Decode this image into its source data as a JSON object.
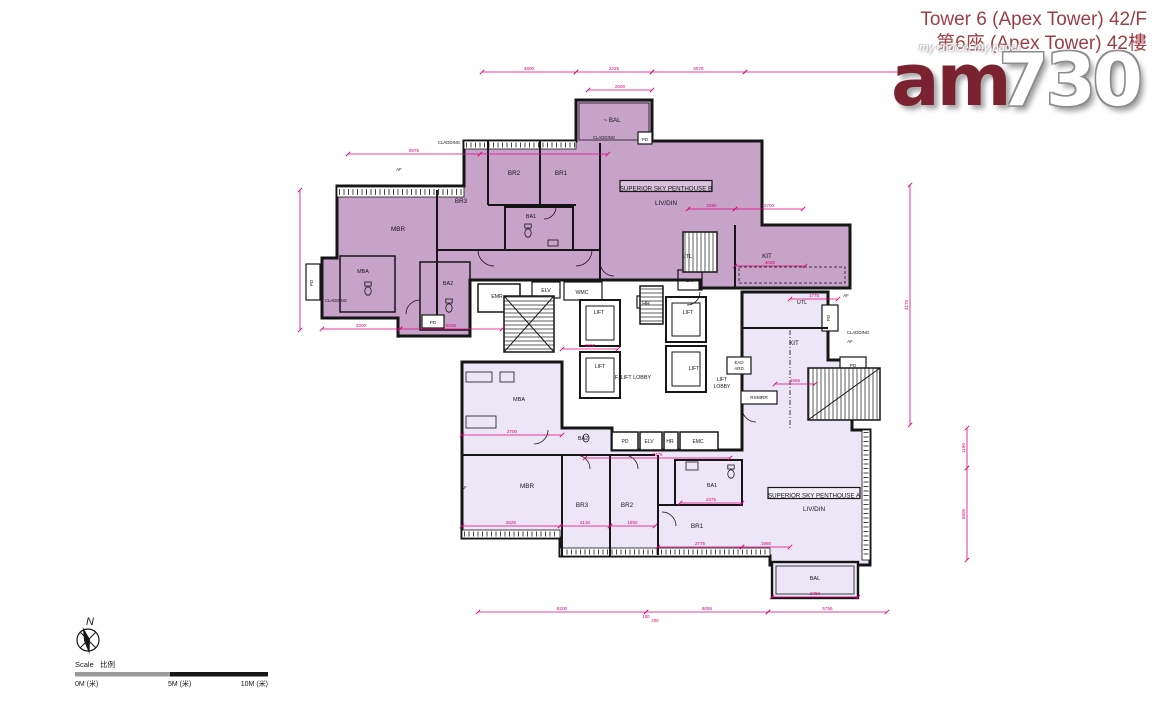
{
  "header": {
    "title_line1": "Tower 6 (Apex Tower) 42/F",
    "title_line2": "第6座 (Apex Tower) 42樓"
  },
  "watermark": {
    "brand_am": "am",
    "brand_730": "730",
    "tagline": "my choice, my paper"
  },
  "colors": {
    "penthouse_b_fill": "#c7a2c9",
    "penthouse_a_fill": "#ece6f6",
    "dimension_pink": "#e0007a",
    "wall_black": "#161616",
    "title_red": "#9c3f45",
    "logo_maroon": "#7a2230",
    "scale_gray": "#9a9a9a"
  },
  "plan": {
    "unit_labels": [
      {
        "text": "SUPERIOR SKY PENTHOUSE B",
        "cx": 666,
        "cy": 189,
        "w": 92,
        "h": 11
      },
      {
        "text": "SUPERIOR SKY PENTHOUSE A",
        "cx": 814,
        "cy": 496,
        "w": 92,
        "h": 11
      }
    ],
    "room_labels": [
      {
        "text": "MBR",
        "x": 398,
        "y": 231
      },
      {
        "text": "BR3",
        "x": 461,
        "y": 203
      },
      {
        "text": "BR2",
        "x": 514,
        "y": 175
      },
      {
        "text": "BR1",
        "x": 561,
        "y": 175
      },
      {
        "text": "BA1",
        "x": 531,
        "y": 218,
        "s": 5.4
      },
      {
        "text": "MBA",
        "x": 363,
        "y": 273,
        "s": 5.4
      },
      {
        "text": "BA2",
        "x": 448,
        "y": 285,
        "s": 5.4
      },
      {
        "text": "LIV/DIN",
        "x": 666,
        "y": 205
      },
      {
        "text": "~ BAL",
        "x": 612,
        "y": 122
      },
      {
        "text": "UTL",
        "x": 687,
        "y": 258,
        "s": 5.4
      },
      {
        "text": "KIT",
        "x": 767,
        "y": 258
      },
      {
        "text": "LAV",
        "x": 690,
        "y": 282,
        "s": 4.6
      },
      {
        "text": "EMR",
        "x": 497,
        "y": 298,
        "s": 5.2
      },
      {
        "text": "ELV",
        "x": 546,
        "y": 292,
        "s": 5.2
      },
      {
        "text": "WMC",
        "x": 582,
        "y": 294,
        "s": 5.2
      },
      {
        "text": "HR",
        "x": 646,
        "y": 305,
        "s": 5.2
      },
      {
        "text": "LIFT",
        "x": 599,
        "y": 314,
        "s": 5.2
      },
      {
        "text": "LIFT",
        "x": 600,
        "y": 368,
        "s": 5.2
      },
      {
        "text": "LIFT",
        "x": 688,
        "y": 314,
        "s": 5.2
      },
      {
        "text": "LIFT",
        "x": 694,
        "y": 370,
        "s": 5.2
      },
      {
        "text": "F. LIFT LOBBY",
        "x": 633,
        "y": 379,
        "s": 5.4
      },
      {
        "text": "LIFT",
        "x": 722,
        "y": 381,
        "s": 5
      },
      {
        "text": "LOBBY",
        "x": 722,
        "y": 388,
        "s": 5
      },
      {
        "text": "EAD",
        "x": 739,
        "y": 364,
        "s": 4.4
      },
      {
        "text": "ARD",
        "x": 739,
        "y": 370,
        "s": 4.4
      },
      {
        "text": "RSMRR",
        "x": 759,
        "y": 399,
        "s": 4.8
      },
      {
        "text": "PD",
        "x": 625,
        "y": 443,
        "s": 5
      },
      {
        "text": "ELV",
        "x": 649,
        "y": 443,
        "s": 5
      },
      {
        "text": "HR",
        "x": 670,
        "y": 443,
        "s": 5
      },
      {
        "text": "EMC",
        "x": 698,
        "y": 443,
        "s": 5
      },
      {
        "text": "PD",
        "x": 433,
        "y": 324,
        "s": 4.6
      },
      {
        "text": "PD",
        "x": 313,
        "y": 283,
        "s": 4.6,
        "rot": -90
      },
      {
        "text": "PD",
        "x": 645,
        "y": 141,
        "s": 4.4
      },
      {
        "text": "MBA",
        "x": 519,
        "y": 401,
        "s": 5.6
      },
      {
        "text": "BA2",
        "x": 583,
        "y": 440,
        "s": 5.4
      },
      {
        "text": "MBR",
        "x": 527,
        "y": 488
      },
      {
        "text": "BR3",
        "x": 582,
        "y": 507
      },
      {
        "text": "BR2",
        "x": 627,
        "y": 507
      },
      {
        "text": "BR1",
        "x": 697,
        "y": 528
      },
      {
        "text": "BA1",
        "x": 712,
        "y": 487,
        "s": 5.4
      },
      {
        "text": "LIV/DIN",
        "x": 814,
        "y": 511
      },
      {
        "text": "BAL",
        "x": 815,
        "y": 580,
        "s": 5.6
      },
      {
        "text": "UTL",
        "x": 802,
        "y": 304,
        "s": 5.4
      },
      {
        "text": "KIT",
        "x": 794,
        "y": 345
      },
      {
        "text": "PD",
        "x": 830,
        "y": 318,
        "s": 4.6,
        "rot": -90
      },
      {
        "text": "PD",
        "x": 853,
        "y": 367,
        "s": 4.6
      }
    ],
    "annotations": [
      {
        "text": "CLADDING",
        "x": 449,
        "y": 144
      },
      {
        "text": "CLADDING",
        "x": 604,
        "y": 139
      },
      {
        "text": "CLADDING",
        "x": 336,
        "y": 302
      },
      {
        "text": "CLADDING",
        "x": 858,
        "y": 334
      },
      {
        "text": "AF",
        "x": 399,
        "y": 171
      },
      {
        "text": "AF",
        "x": 850,
        "y": 343
      },
      {
        "text": "AF",
        "x": 846,
        "y": 297
      },
      {
        "text": "AF",
        "x": 399,
        "y": 338
      },
      {
        "text": "AF",
        "x": 464,
        "y": 489
      }
    ],
    "dimensions": [
      {
        "o": "h",
        "x1": 482,
        "x2": 576,
        "y": 72,
        "label": "4800"
      },
      {
        "o": "h",
        "x1": 576,
        "x2": 652,
        "y": 72,
        "label": "2225"
      },
      {
        "o": "h",
        "x1": 652,
        "x2": 745,
        "y": 72,
        "label": "6075"
      },
      {
        "o": "h",
        "x1": 745,
        "x2": 905,
        "y": 72,
        "label": ""
      },
      {
        "o": "h",
        "x1": 588,
        "x2": 652,
        "y": 90,
        "label": "2600"
      },
      {
        "o": "h",
        "x1": 348,
        "x2": 480,
        "y": 154,
        "label": "8975"
      },
      {
        "o": "h",
        "x1": 480,
        "x2": 608,
        "y": 154,
        "label": ""
      },
      {
        "o": "h",
        "x1": 322,
        "x2": 400,
        "y": 329,
        "label": "3300"
      },
      {
        "o": "h",
        "x1": 400,
        "x2": 502,
        "y": 329,
        "label": "6035"
      },
      {
        "o": "h",
        "x1": 688,
        "x2": 735,
        "y": 209,
        "label": "2380"
      },
      {
        "o": "h",
        "x1": 735,
        "x2": 803,
        "y": 209,
        "label": "2700"
      },
      {
        "o": "h",
        "x1": 735,
        "x2": 805,
        "y": 266,
        "label": "4000"
      },
      {
        "o": "h",
        "x1": 790,
        "x2": 838,
        "y": 299,
        "label": "1775"
      },
      {
        "o": "h",
        "x1": 562,
        "x2": 618,
        "y": 349,
        "label": "2800"
      },
      {
        "o": "h",
        "x1": 462,
        "x2": 562,
        "y": 435,
        "label": "2700"
      },
      {
        "o": "h",
        "x1": 585,
        "x2": 730,
        "y": 458,
        "label": "7475"
      },
      {
        "o": "h",
        "x1": 680,
        "x2": 742,
        "y": 503,
        "label": "2375"
      },
      {
        "o": "h",
        "x1": 462,
        "x2": 560,
        "y": 526,
        "label": "2625"
      },
      {
        "o": "h",
        "x1": 560,
        "x2": 610,
        "y": 526,
        "label": "2130"
      },
      {
        "o": "h",
        "x1": 610,
        "x2": 655,
        "y": 526,
        "label": "1850"
      },
      {
        "o": "h",
        "x1": 658,
        "x2": 742,
        "y": 547,
        "label": "2775"
      },
      {
        "o": "h",
        "x1": 742,
        "x2": 790,
        "y": 547,
        "label": "1980"
      },
      {
        "o": "h",
        "x1": 775,
        "x2": 815,
        "y": 384,
        "label": "1965"
      },
      {
        "o": "h",
        "x1": 772,
        "x2": 858,
        "y": 597,
        "label": "2750"
      },
      {
        "o": "h",
        "x1": 478,
        "x2": 646,
        "y": 612,
        "label": "8200"
      },
      {
        "o": "h",
        "x1": 646,
        "x2": 768,
        "y": 612,
        "label": "6055"
      },
      {
        "o": "h",
        "x1": 768,
        "x2": 887,
        "y": 612,
        "label": "5755"
      },
      {
        "o": "v",
        "x": 910,
        "y1": 185,
        "y2": 425,
        "label": "4175"
      },
      {
        "o": "v",
        "x": 967,
        "y1": 428,
        "y2": 468,
        "label": "1190"
      },
      {
        "o": "v",
        "x": 967,
        "y1": 468,
        "y2": 560,
        "label": "5805"
      },
      {
        "o": "v",
        "x": 300,
        "y1": 190,
        "y2": 330,
        "label": ""
      }
    ],
    "stray_dims": [
      {
        "text": "100",
        "x": 646,
        "y": 618
      },
      {
        "text": "200",
        "x": 655,
        "y": 622
      }
    ]
  },
  "compass": {
    "north_label": "N"
  },
  "scale_bar": {
    "title_en": "Scale",
    "title_zh": "比例",
    "tick0": "0M (米)",
    "tick5": "5M (米)",
    "tick10": "10M (米)"
  }
}
